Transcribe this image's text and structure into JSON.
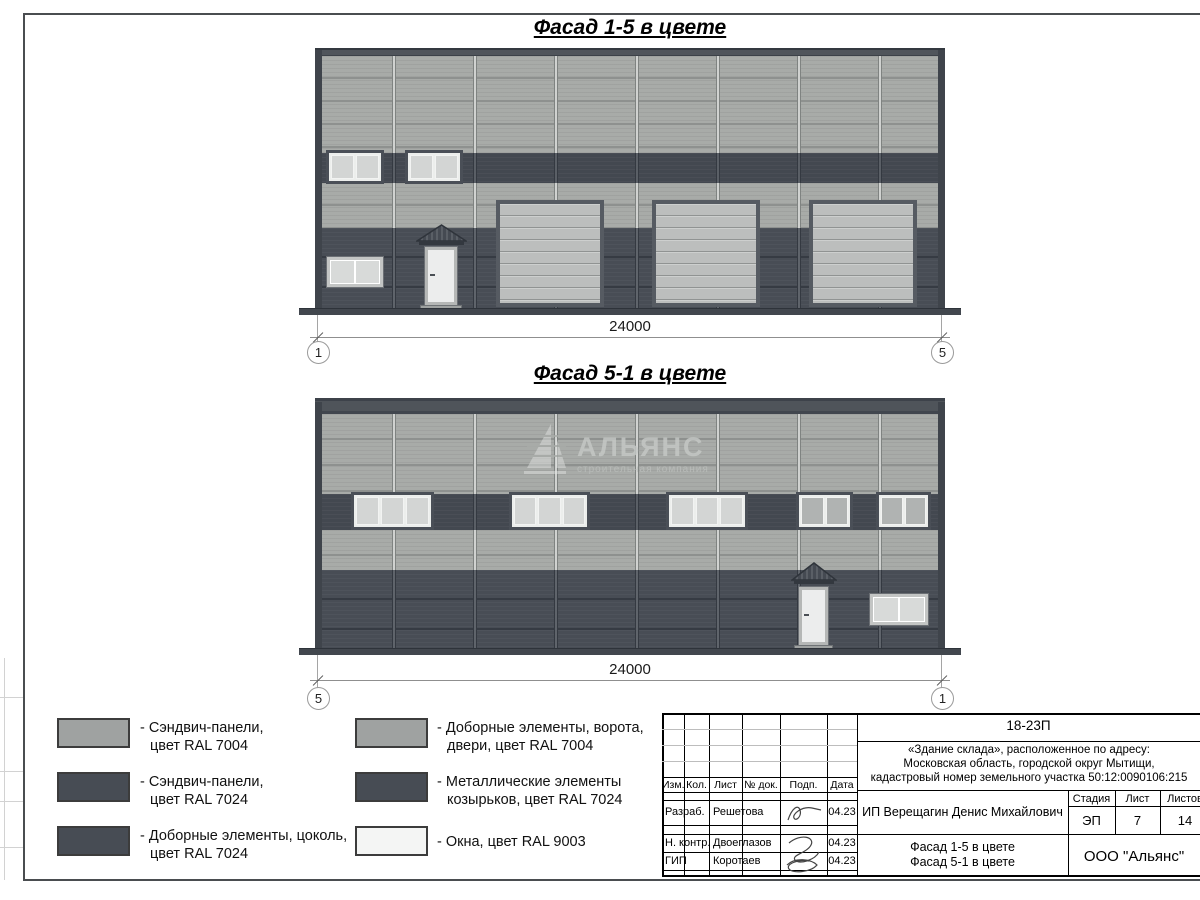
{
  "sheet": {
    "titles": {
      "facade_1_5": "Фасад 1-5 в цвете",
      "facade_5_1": "Фасад 5-1 в цвете"
    },
    "dimensions": {
      "facade_1_5": {
        "length": "24000",
        "axis_left": "1",
        "axis_right": "5"
      },
      "facade_5_1": {
        "length": "24000",
        "axis_left": "5",
        "axis_right": "1"
      }
    },
    "watermark": {
      "name": "АЛЬЯНС",
      "subtitle": "строительная компания"
    }
  },
  "legend": {
    "items": [
      {
        "line1": "- Сэндвич-панели,",
        "line2": "цвет RAL 7004",
        "color": "#9fa2a1"
      },
      {
        "line1": "- Сэндвич-панели,",
        "line2": "цвет RAL 7024",
        "color": "#474c54"
      },
      {
        "line1": "- Доборные элементы, цоколь,",
        "line2": "цвет RAL 7024",
        "color": "#474c54"
      },
      {
        "line1": "- Доборные элементы, ворота,",
        "line2": "двери, цвет RAL 7004",
        "color": "#9fa2a1"
      },
      {
        "line1": "- Металлические элементы",
        "line2": "козырьков, цвет RAL 7024",
        "color": "#474c54"
      },
      {
        "line1": "- Окна, цвет RAL 9003",
        "line2": "",
        "color": "#f4f5f4"
      }
    ]
  },
  "title_block": {
    "project_code": "18-23П",
    "object_address_lines": [
      "«Здание склада», расположенное по адресу:",
      "Московская область, городской округ Мытищи,",
      "кадастровый номер земельного участка 50:12:0090106:215"
    ],
    "header_columns": [
      "Изм.",
      "Кол.",
      "Лист",
      "№ док.",
      "Подп.",
      "Дата"
    ],
    "signature_rows": [
      {
        "role": "Разраб.",
        "name": "Решетова",
        "date": "04.23"
      },
      {
        "role": "Н. контр.",
        "name": "Двоеглазов",
        "date": "04.23"
      },
      {
        "role": "ГИП",
        "name": "Коротаев",
        "date": "04.23"
      }
    ],
    "client": "ИП Верещагин Денис Михайлович",
    "stage_columns": [
      "Стадия",
      "Лист",
      "Листов"
    ],
    "stage_values": [
      "ЭП",
      "7",
      "14"
    ],
    "sheet_content_lines": [
      "Фасад 1-5 в цвете",
      "Фасад 5-1 в цвете"
    ],
    "organization": "ООО \"Альянс\""
  },
  "colors": {
    "ral_7004_panels": "#9fa2a1",
    "ral_7024_panels": "#474c54",
    "ral_9003_windows": "#f4f5f4"
  }
}
